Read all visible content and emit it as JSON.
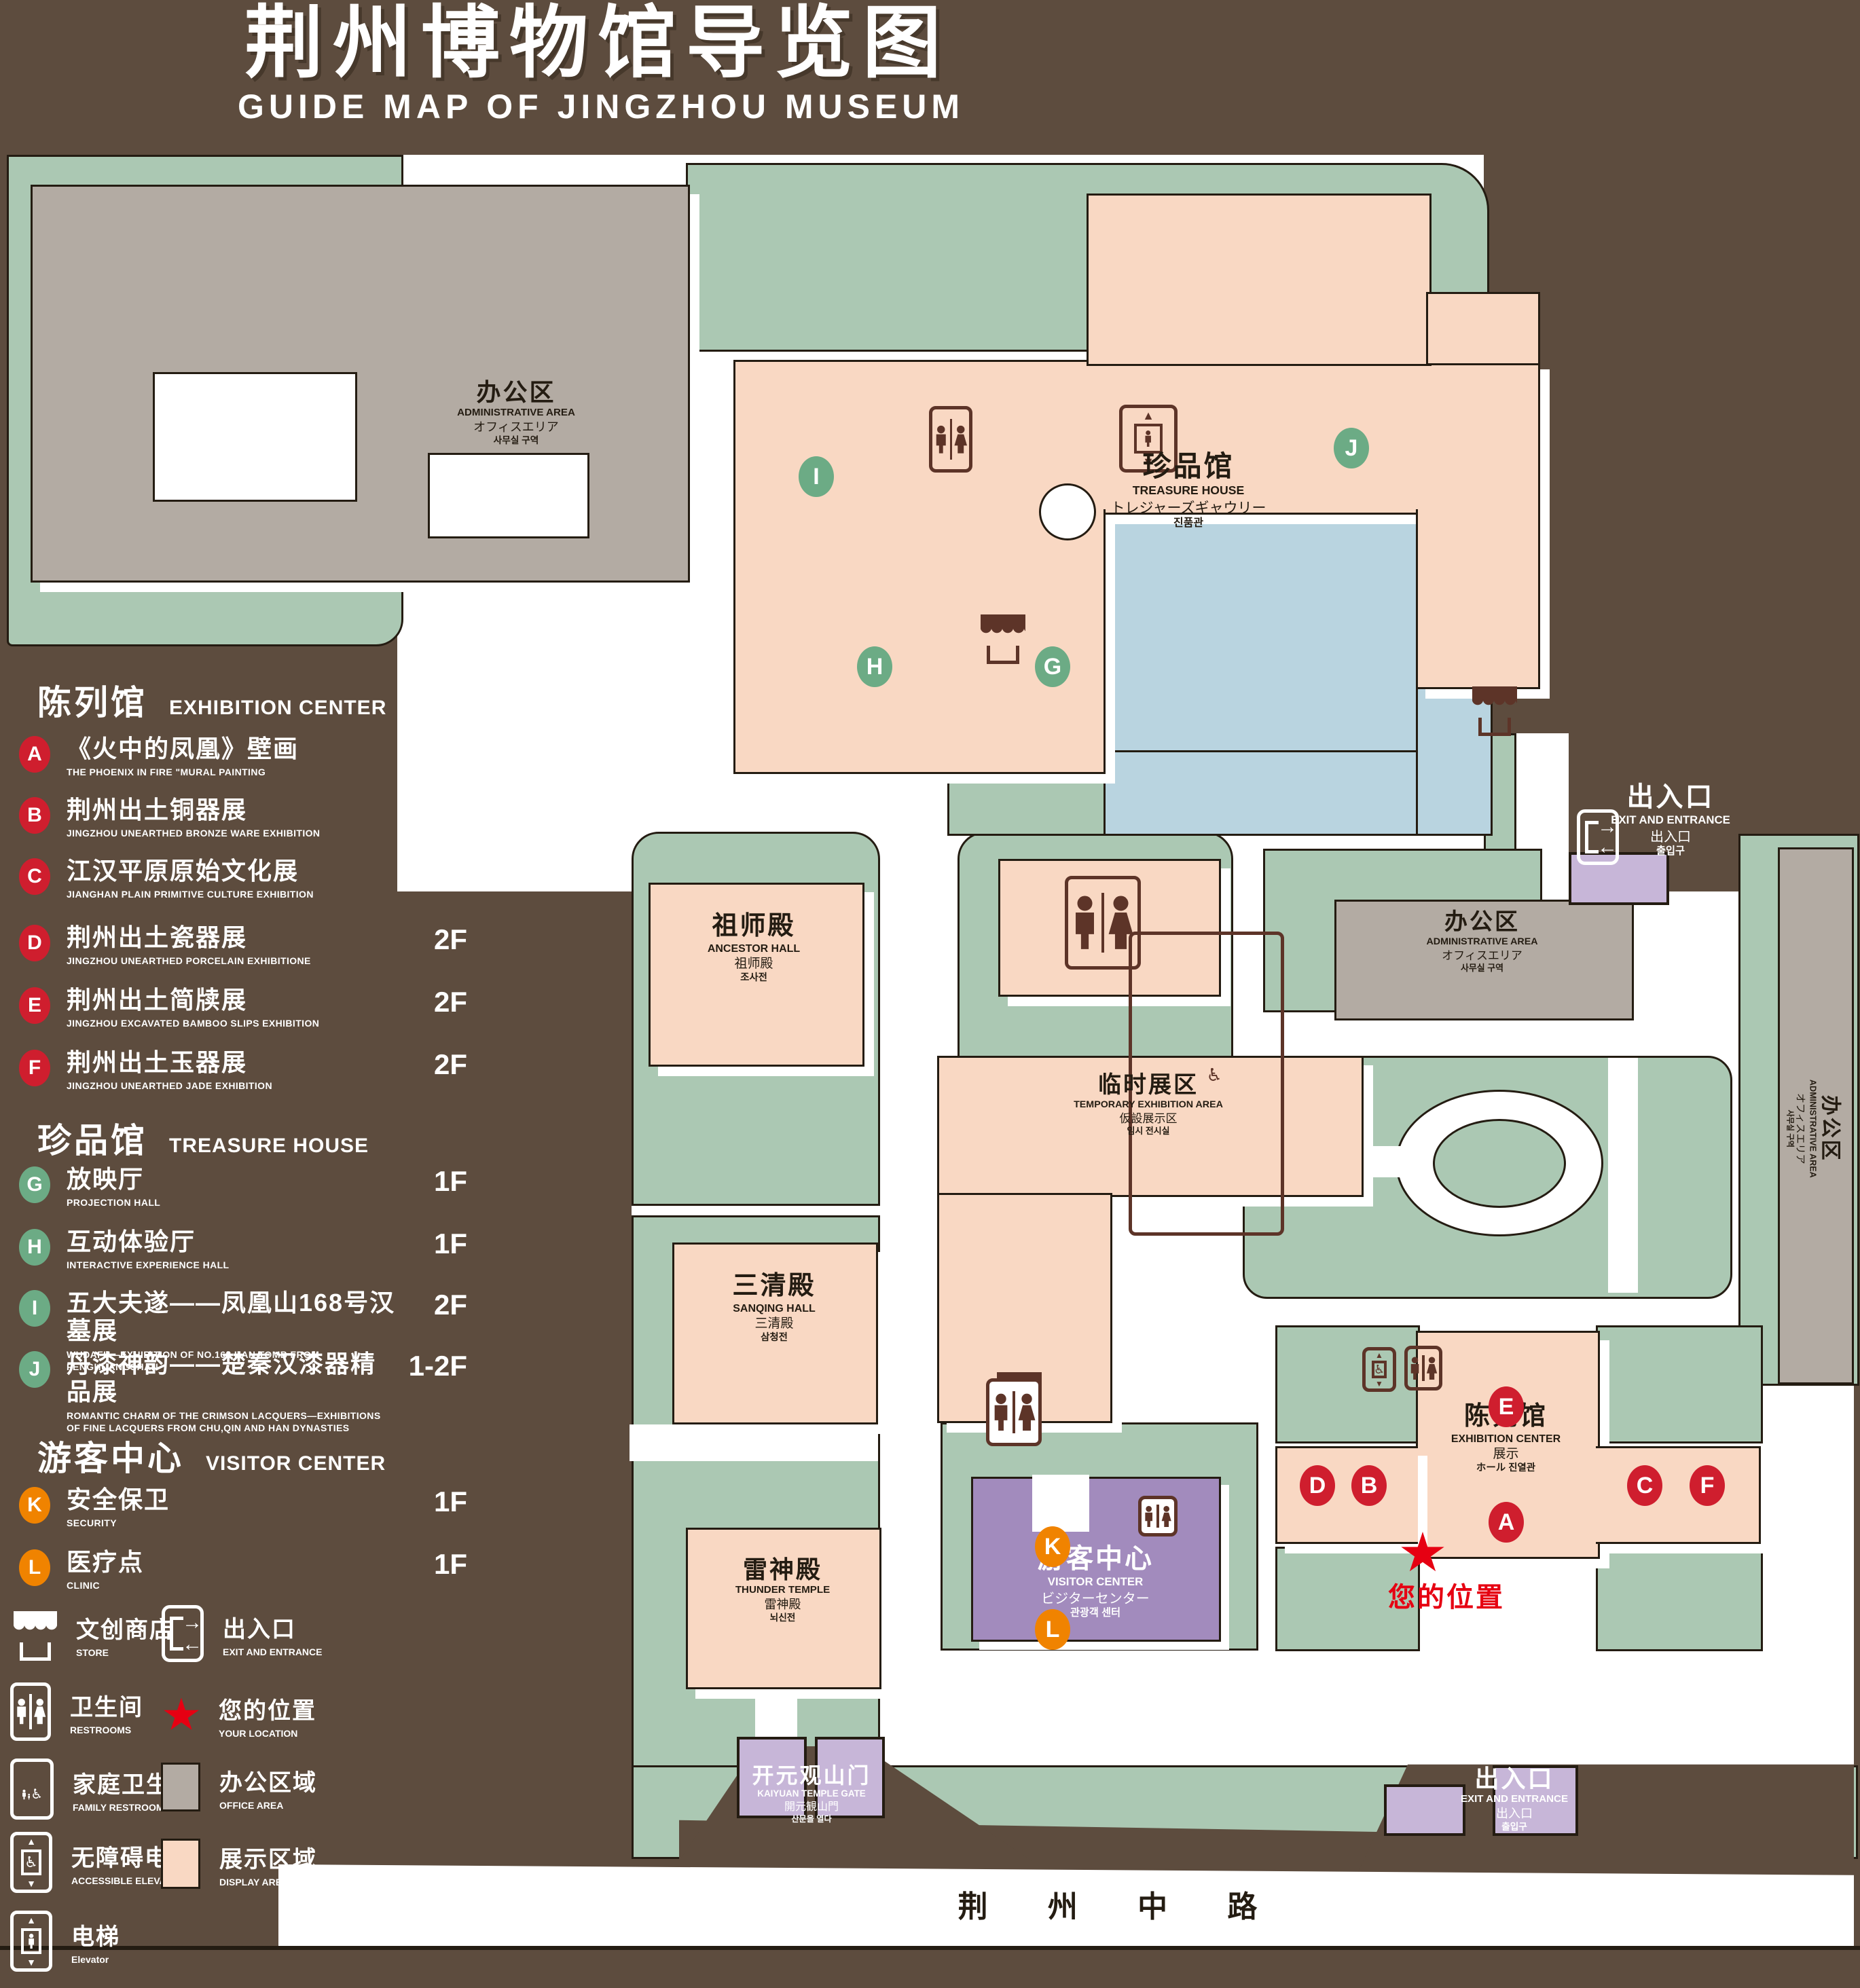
{
  "title": {
    "zh": "荆州博物馆导览图",
    "en": "GUIDE MAP OF JINGZHOU MUSEUM"
  },
  "colors": {
    "background": "#5d4c3e",
    "green": "#abc8b3",
    "display_area": "#f9d8c3",
    "office_area": "#b3aba3",
    "lake": "#b9d4e0",
    "visitor": "#a28bbd",
    "badge_red": "#cf1e2e",
    "badge_green": "#6cab85",
    "badge_orange": "#f08300",
    "location_red": "#e60012"
  },
  "legend": {
    "sections": [
      {
        "zh": "陈列馆",
        "en": "EXHIBITION CENTER",
        "items": [
          {
            "letter": "A",
            "zh": "《火中的凤凰》壁画",
            "en": "THE PHOENIX IN FIRE \"MURAL PAINTING",
            "floor": "1F"
          },
          {
            "letter": "B",
            "zh": "荆州出土铜器展",
            "en": "JINGZHOU UNEARTHED BRONZE WARE EXHIBITION",
            "floor": "1F"
          },
          {
            "letter": "C",
            "zh": "江汉平原原始文化展",
            "en": "JIANGHAN PLAIN PRIMITIVE CULTURE EXHIBITION",
            "floor": "1F"
          },
          {
            "letter": "D",
            "zh": "荆州出土瓷器展",
            "en": "JINGZHOU UNEARTHED PORCELAIN EXHIBITIONE",
            "floor": "2F"
          },
          {
            "letter": "E",
            "zh": "荆州出土简牍展",
            "en": "JINGZHOU EXCAVATED BAMBOO SLIPS EXHIBITION",
            "floor": "2F"
          },
          {
            "letter": "F",
            "zh": "荆州出土玉器展",
            "en": "JINGZHOU UNEARTHED JADE EXHIBITION",
            "floor": "2F"
          }
        ]
      },
      {
        "zh": "珍品馆",
        "en": "TREASURE HOUSE",
        "items": [
          {
            "letter": "G",
            "zh": "放映厅",
            "en": "PROJECTION HALL",
            "floor": "1F"
          },
          {
            "letter": "H",
            "zh": "互动体验厅",
            "en": "INTERACTIVE EXPERIENCE HALL",
            "floor": "1F"
          },
          {
            "letter": "I",
            "zh": "五大夫遂——凤凰山168号汉墓展",
            "en": "WUDAFU—EXHIBITION OF NO.168 HAN TOMB FROM FENGHUANGSHAN",
            "floor": "2F"
          },
          {
            "letter": "J",
            "zh": "丹漆神韵——楚秦汉漆器精品展",
            "en": "ROMANTIC CHARM OF THE CRIMSON LACQUERS—EXHIBITIONS OF FINE LACQUERS FROM CHU,QIN AND HAN DYNASTIES",
            "floor": "1-2F"
          }
        ]
      },
      {
        "zh": "游客中心",
        "en": "VISITOR CENTER",
        "items": [
          {
            "letter": "K",
            "zh": "安全保卫",
            "en": "SECURITY",
            "floor": "1F"
          },
          {
            "letter": "L",
            "zh": "医疗点",
            "en": "CLINIC",
            "floor": "1F"
          }
        ]
      }
    ],
    "symbols": [
      {
        "icon": "store-icon",
        "zh": "文创商店",
        "en": "STORE"
      },
      {
        "icon": "exit-icon",
        "zh": "出入口",
        "en": "EXIT AND ENTRANCE"
      },
      {
        "icon": "restrooms-icon",
        "zh": "卫生间",
        "en": "RESTROOMS"
      },
      {
        "icon": "your-location-star",
        "zh": "您的位置",
        "en": "YOUR LOCATION"
      },
      {
        "icon": "family-restrooms-icon",
        "zh": "家庭卫生间",
        "en": "FAMILY RESTROOMS"
      },
      {
        "icon": "office-area-swatch",
        "zh": "办公区域",
        "en": "OFFICE AREA"
      },
      {
        "icon": "accessible-elevator-icon",
        "zh": "无障碍电梯",
        "en": "ACCESSIBLE ELEVATOR"
      },
      {
        "icon": "display-area-swatch",
        "zh": "展示区域",
        "en": "DISPLAY AREA"
      },
      {
        "icon": "elevator-icon",
        "zh": "电梯",
        "en": "Elevator"
      }
    ]
  },
  "map": {
    "admin": {
      "zh": "办公区",
      "en": "ADMINISTRATIVE AREA",
      "ja": "オフィスエリア",
      "ko": "사무실 구역"
    },
    "treasure_house": {
      "zh": "珍品馆",
      "en": "TREASURE HOUSE",
      "ja": "トレジャーズギャウリー",
      "ko": "진품관"
    },
    "ancestor_hall": {
      "zh": "祖师殿",
      "en": "ANCESTOR HALL",
      "ja": "祖师殿",
      "ko": "조사전"
    },
    "sanqing_hall": {
      "zh": "三清殿",
      "en": "SANQING HALL",
      "ja": "三清殿",
      "ko": "삼청전"
    },
    "thunder_temple": {
      "zh": "雷神殿",
      "en": "THUNDER TEMPLE",
      "ja": "雷神殿",
      "ko": "뇌신전"
    },
    "temporary_exhibition": {
      "zh": "临时展区",
      "en": "TEMPORARY EXHIBITION AREA",
      "ja": "仮設展示区",
      "ko": "임시 전시실"
    },
    "exhibition_center": {
      "zh": "陈列馆",
      "en": "EXHIBITION CENTER",
      "line3": "展示",
      "line4": "ホール 진열관"
    },
    "visitor_center": {
      "zh": "游客中心",
      "en": "VISITOR CENTER",
      "ja": "ビジターセンター",
      "ko": "관광객 센터"
    },
    "kaiyuan_gate": {
      "zh": "开元观山门",
      "en": "KAIYUAN TEMPLE GATE",
      "ja": "開元観山門",
      "ko": "산문을 열다"
    },
    "exit": {
      "zh": "出入口",
      "en": "EXIT AND ENTRANCE",
      "ja": "出入口",
      "ko": "출입구"
    },
    "road": {
      "zh": "荆 州 中 路"
    },
    "your_location": {
      "zh": "您的位置"
    }
  }
}
